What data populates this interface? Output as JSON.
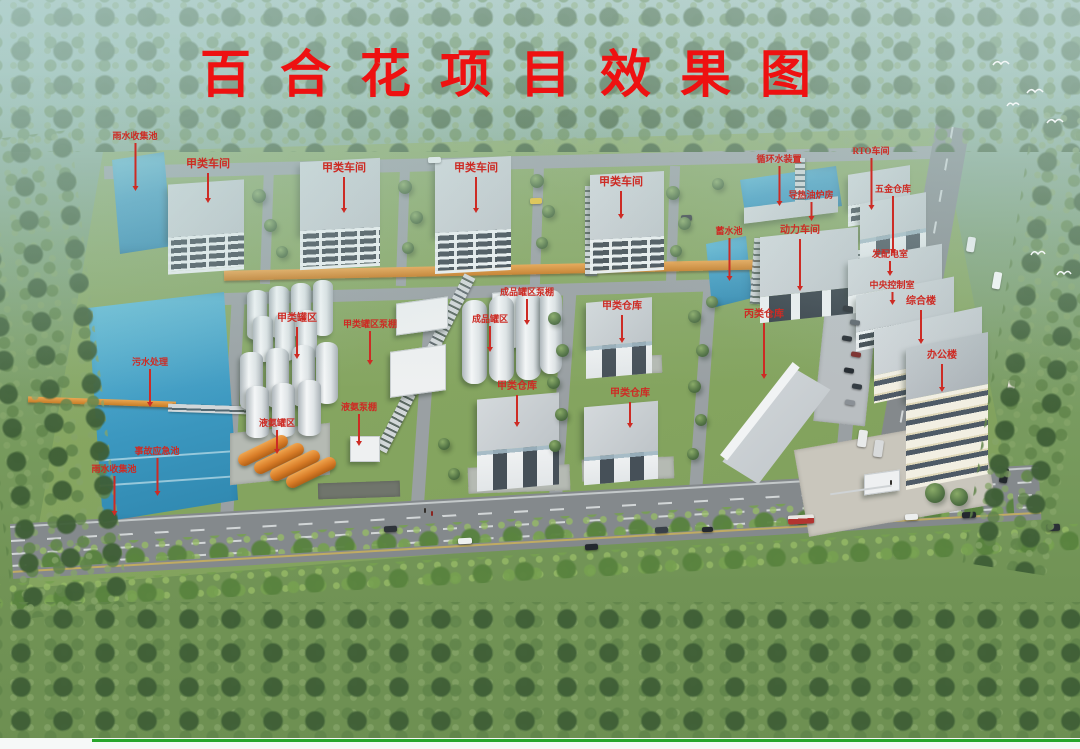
{
  "title": {
    "text": "百合花项目效果图"
  },
  "palette": {
    "title_red": "#ee1111",
    "label_red": "#cd2b24",
    "road_gray": "#9aa0a3",
    "main_road_gray": "#84898c",
    "wall_white": "#f1f3f4",
    "roof_gray": "#c7cdd1",
    "water_blue": "#3f9cc4",
    "pipe_orange": "#d68a33",
    "tank_orange": "#d97d28",
    "grass_green": "#779a5d",
    "tree_green": "#4c6b44",
    "bottom_line_green": "#27a62c"
  },
  "labels": [
    {
      "text": "雨水收集池",
      "x": 135,
      "y": 132,
      "len": 46,
      "size": 9
    },
    {
      "text": "甲类车间",
      "x": 208,
      "y": 159,
      "len": 28,
      "size": 11
    },
    {
      "text": "甲类车间",
      "x": 344,
      "y": 163,
      "len": 34,
      "size": 11
    },
    {
      "text": "甲类车间",
      "x": 476,
      "y": 163,
      "len": 34,
      "size": 11
    },
    {
      "text": "甲类车间",
      "x": 621,
      "y": 177,
      "len": 26,
      "size": 11
    },
    {
      "text": "循环水装置",
      "x": 779,
      "y": 155,
      "len": 38,
      "size": 9
    },
    {
      "text": "RTO车间",
      "x": 871,
      "y": 147,
      "len": 50,
      "size": 9
    },
    {
      "text": "五金仓库",
      "x": 893,
      "y": 185,
      "len": 56,
      "size": 9
    },
    {
      "text": "导热油炉房",
      "x": 811,
      "y": 191,
      "len": 17,
      "size": 9
    },
    {
      "text": "蓄水池",
      "x": 729,
      "y": 227,
      "len": 41,
      "size": 9
    },
    {
      "text": "动力车间",
      "x": 800,
      "y": 226,
      "len": 50,
      "size": 10
    },
    {
      "text": "发配电室",
      "x": 890,
      "y": 250,
      "len": 13,
      "size": 9
    },
    {
      "text": "中央控制室",
      "x": 892,
      "y": 281,
      "len": 11,
      "size": 9
    },
    {
      "text": "综合楼",
      "x": 921,
      "y": 297,
      "len": 32,
      "size": 10
    },
    {
      "text": "办公楼",
      "x": 942,
      "y": 351,
      "len": 26,
      "size": 10
    },
    {
      "text": "甲类罐区",
      "x": 297,
      "y": 314,
      "len": 30,
      "size": 10
    },
    {
      "text": "甲类罐区泵棚",
      "x": 370,
      "y": 320,
      "len": 32,
      "size": 9
    },
    {
      "text": "成品罐区泵棚",
      "x": 527,
      "y": 288,
      "len": 24,
      "size": 9
    },
    {
      "text": "成品罐区",
      "x": 490,
      "y": 315,
      "len": 24,
      "size": 9
    },
    {
      "text": "甲类仓库",
      "x": 622,
      "y": 302,
      "len": 26,
      "size": 10
    },
    {
      "text": "丙类仓库",
      "x": 764,
      "y": 310,
      "len": 54,
      "size": 10
    },
    {
      "text": "污水处理",
      "x": 150,
      "y": 358,
      "len": 36,
      "size": 9
    },
    {
      "text": "液氨泵棚",
      "x": 359,
      "y": 403,
      "len": 30,
      "size": 9
    },
    {
      "text": "甲类仓库",
      "x": 517,
      "y": 382,
      "len": 30,
      "size": 10
    },
    {
      "text": "甲类仓库",
      "x": 630,
      "y": 389,
      "len": 24,
      "size": 10
    },
    {
      "text": "液氨罐区",
      "x": 277,
      "y": 419,
      "len": 22,
      "size": 9
    },
    {
      "text": "事故应急池",
      "x": 157,
      "y": 447,
      "len": 36,
      "size": 9
    },
    {
      "text": "雨水收集池",
      "x": 114,
      "y": 465,
      "len": 38,
      "size": 9
    }
  ]
}
